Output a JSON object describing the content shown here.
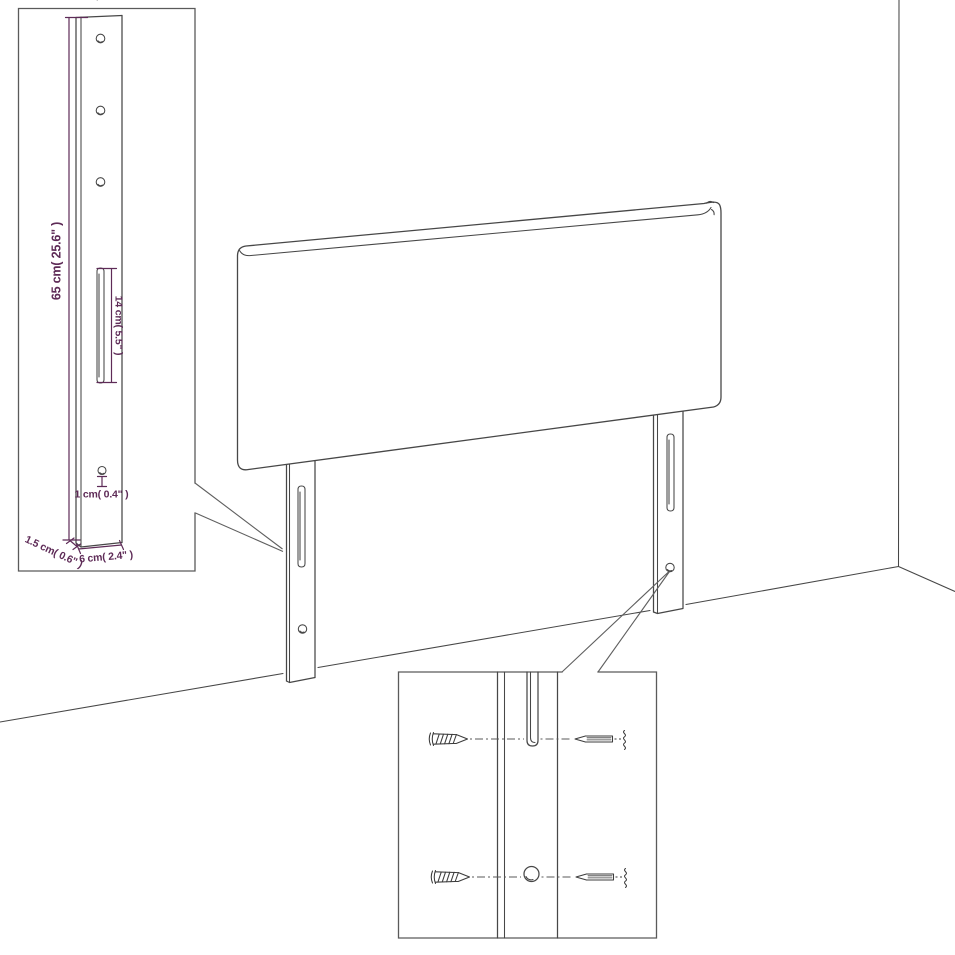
{
  "diagram": {
    "type": "product-dimension-diagram",
    "subject": "upholstered-headboard-with-two-mounting-legs",
    "colors": {
      "line": "#474747",
      "inset-border": "#5a5a5a",
      "dimension": "#5e2b57",
      "background": "#ffffff"
    },
    "inset_post": {
      "labels": {
        "height": "65 cm( 25.6\" )",
        "slot_length": "14 cm( 5.5\" )",
        "hole_diameter": "1 cm( 0.4\" )",
        "post_depth": "1.5 cm( 0.6\" )",
        "post_width": "6 cm( 2.4\" )"
      }
    },
    "inset_screws": {
      "icons": {
        "front": "wood-screw-front-view-icon",
        "side": "wood-screw-side-view-icon"
      }
    }
  }
}
